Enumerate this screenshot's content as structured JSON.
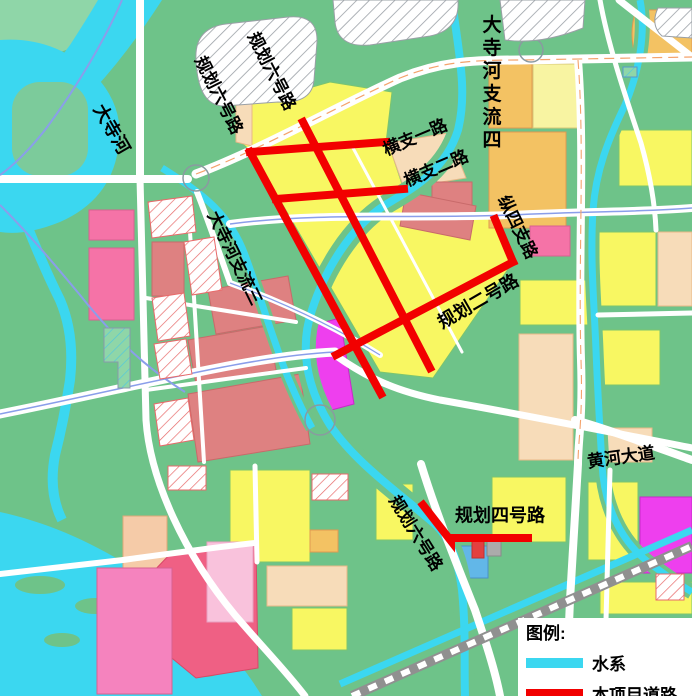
{
  "map": {
    "labels": [
      {
        "text": "规划六号路",
        "x": 219,
        "y": 95,
        "rot": 63,
        "size": 17
      },
      {
        "text": "规划六号路",
        "x": 272,
        "y": 71,
        "rot": 63,
        "size": 17
      },
      {
        "text": "大寺河",
        "x": 112,
        "y": 129,
        "rot": 60,
        "size": 18
      },
      {
        "text": "大寺河支流四",
        "x": 492,
        "y": 12,
        "rot": 0,
        "size": 19,
        "vertical": true,
        "spacing": 23
      },
      {
        "text": "横支一路",
        "x": 415,
        "y": 137,
        "rot": -23,
        "size": 17
      },
      {
        "text": "横支二路",
        "x": 436,
        "y": 168,
        "rot": -23,
        "size": 17
      },
      {
        "text": "纵四支路",
        "x": 518,
        "y": 227,
        "rot": 64,
        "size": 17
      },
      {
        "text": "规划二号路",
        "x": 478,
        "y": 301,
        "rot": -30,
        "size": 18
      },
      {
        "text": "大寺河支流三",
        "x": 235,
        "y": 258,
        "rot": 64,
        "size": 17
      },
      {
        "text": "黄河大道",
        "x": 621,
        "y": 457,
        "rot": -8,
        "size": 17
      },
      {
        "text": "规划四号路",
        "x": 500,
        "y": 515,
        "rot": 0,
        "size": 18
      },
      {
        "text": "规划六号路",
        "x": 416,
        "y": 533,
        "rot": 58,
        "size": 17
      }
    ],
    "legend": {
      "title": "图例:",
      "items": [
        {
          "label": "水系",
          "color": "#3BD7F0"
        },
        {
          "label": "本项目道路",
          "color": "#F20000"
        }
      ]
    },
    "colors": {
      "water": "#3BD7F0",
      "land": "#6EC389",
      "land_light": "#8FD6A8",
      "project_road": "#F20000",
      "road": "#FFFFFF",
      "railway": "#909090",
      "parcel_yellow": "#F8F762",
      "parcel_orange": "#F3C263",
      "parcel_peach": "#F7DCB9",
      "parcel_rose": "#DE8181",
      "parcel_pink": "#F573A7",
      "parcel_magenta": "#EE3FEE"
    }
  }
}
